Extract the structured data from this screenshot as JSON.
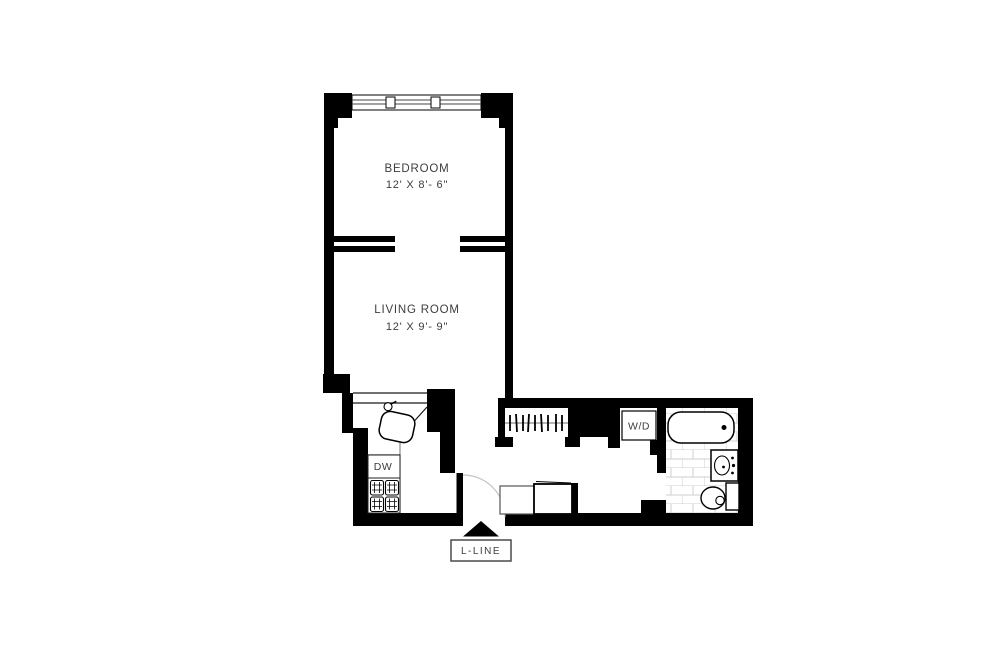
{
  "document": {
    "type": "apartment-floor-plan"
  },
  "rooms": {
    "bedroom": {
      "label": "BEDROOM",
      "dims": "12' X 8'- 6\""
    },
    "living_room": {
      "label": "LIVING ROOM",
      "dims": "12' X 9'- 9\""
    }
  },
  "appliances": {
    "dishwasher_label": "DW",
    "washer_dryer_label": "W/D"
  },
  "entry": {
    "line_label": "L-LINE"
  },
  "colors": {
    "walls": "#000000",
    "text": "#3d3d3d",
    "tile_lines": "#cfcfcf",
    "door_arc": "#c4c4c4",
    "background": "#ffffff"
  }
}
